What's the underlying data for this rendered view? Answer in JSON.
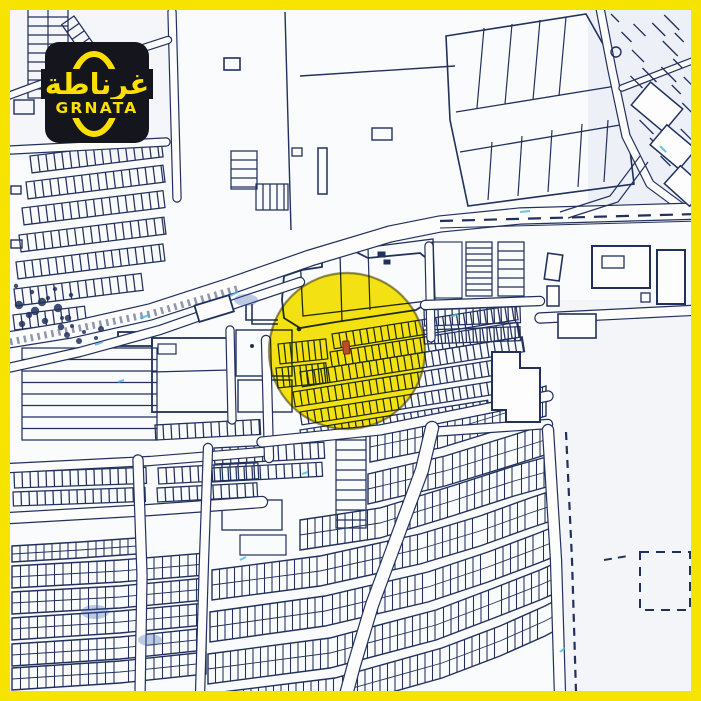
{
  "type": "real-estate-location-map-flyer",
  "logo": {
    "arabic": "غرناطة",
    "latin": "GRNATA"
  },
  "theme": {
    "frame_yellow": "#f6e400",
    "logo_bg": "#15151e",
    "logo_accent": "#ffdf00",
    "map_ink": "#21305c",
    "map_paper": "#fafbfd",
    "road_fill": "#fdfdfe",
    "highlight_yellow": "#f8e300",
    "highlight_rim": "#55500a",
    "marker_red": "#bf4a2c",
    "scan_cyan": "#49b6e0"
  },
  "highlight": {
    "shape": "circle",
    "cx": 347,
    "cy": 351,
    "r": 78,
    "marker": {
      "x": 343,
      "y": 341,
      "w": 6.5,
      "h": 13
    }
  }
}
